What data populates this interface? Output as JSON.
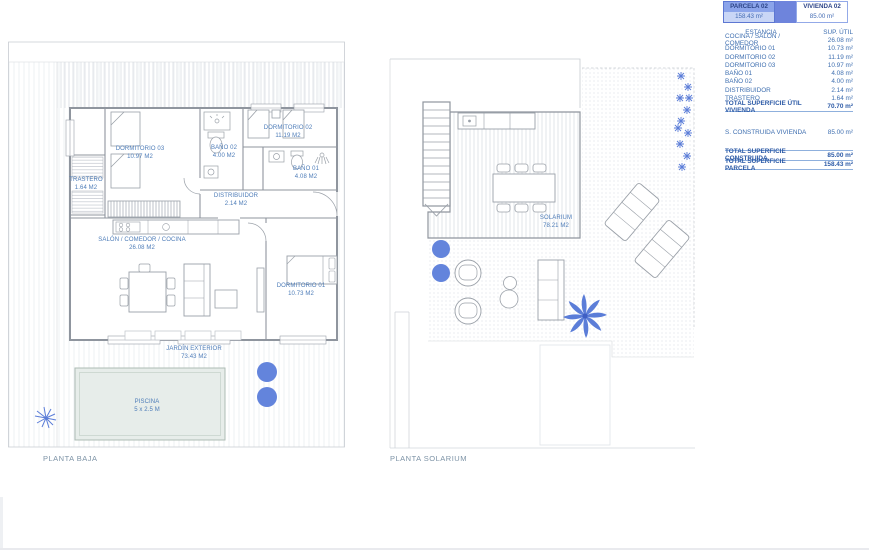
{
  "header": {
    "parcela": {
      "label": "PARCELA 02",
      "value": "158.43 m²"
    },
    "vivienda": {
      "label": "VIVIENDA 02",
      "value": "85.00 m²"
    }
  },
  "areas_table": {
    "col_estancia": "ESTANCIA",
    "col_sup": "SUP. ÚTIL",
    "rows": [
      {
        "label": "COCINA / SALÓN / COMEDOR",
        "value": "26.08 m²"
      },
      {
        "label": "DORMITORIO 01",
        "value": "10.73 m²"
      },
      {
        "label": "DORMITORIO 02",
        "value": "11.19 m²"
      },
      {
        "label": "DORMITORIO 03",
        "value": "10.97 m²"
      },
      {
        "label": "BAÑO 01",
        "value": "4.08 m²"
      },
      {
        "label": "BAÑO 02",
        "value": "4.00 m²"
      },
      {
        "label": "DISTRIBUIDOR",
        "value": "2.14 m²"
      },
      {
        "label": "TRASTERO",
        "value": "1.64 m²"
      }
    ],
    "total_util": {
      "label": "TOTAL SUPERFICIE ÚTIL VIVIENDA",
      "value": "70.70 m²"
    },
    "construida": {
      "label": "S. CONSTRUIDA VIVIENDA",
      "value": "85.00 m²"
    },
    "total_construida": {
      "label": "TOTAL SUPERFICIE CONSTRUIDA",
      "value": "85.00 m²"
    },
    "total_parcela": {
      "label": "TOTAL SUPERFICIE PARCELA",
      "value": "158.43 m²"
    }
  },
  "plan_baja": {
    "title": "PLANTA BAJA",
    "rooms": {
      "dormitorio03": {
        "name": "DORMITORIO 03",
        "area": "10.97 M2"
      },
      "bano02": {
        "name": "BAÑO 02",
        "area": "4.00 M2"
      },
      "dormitorio02": {
        "name": "DORMITORIO 02",
        "area": "11.19 M2"
      },
      "bano01": {
        "name": "BAÑO 01",
        "area": "4.08 M2"
      },
      "trastero": {
        "name": "TRASTERO",
        "area": "1.64 M2"
      },
      "distribuidor": {
        "name": "DISTRIBUIDOR",
        "area": "2.14 M2"
      },
      "salon": {
        "name": "SALÓN / COMEDOR / COCINA",
        "area": "26.08 M2"
      },
      "dormitorio01": {
        "name": "DORMITORIO 01",
        "area": "10.73 M2"
      },
      "jardin": {
        "name": "JARDÍN EXTERIOR",
        "area": "73.43 M2"
      },
      "piscina": {
        "name": "PISCINA",
        "area": "5 x 2.5 M"
      }
    }
  },
  "plan_solarium": {
    "title": "PLANTA SOLARIUM",
    "rooms": {
      "solarium": {
        "name": "SOLARIUM",
        "area": "78.21 M2"
      }
    }
  },
  "colors": {
    "accent_blue": "#5b7dd8",
    "table_text": "#3f6fb0",
    "box_header_blue": "#8ba4ea",
    "box_value_blue": "#c9d6f6",
    "pool_fill": "#e7edea",
    "line_gray": "#8f959e"
  }
}
